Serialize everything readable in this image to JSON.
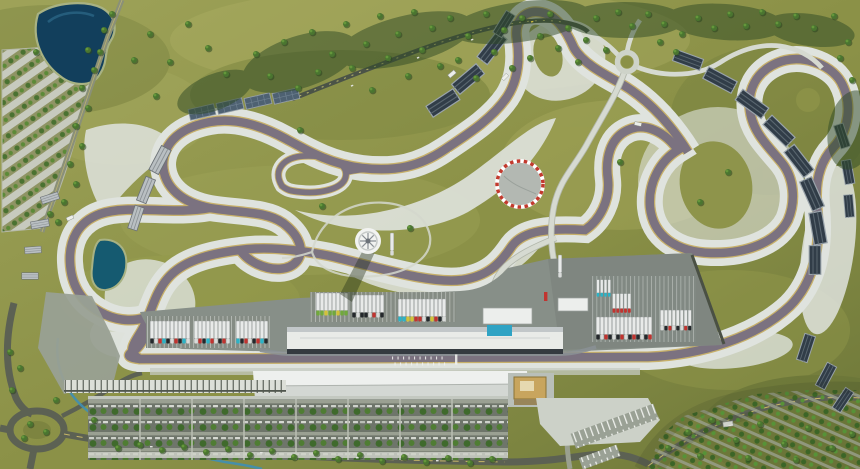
{
  "scene": {
    "kind": "aerial-3d-render",
    "subject": "grand-prix-circuit-complex",
    "view": "top-down"
  },
  "colors": {
    "grass_base": "#8b9147",
    "grass_light": "#a9ad62",
    "grass_dark": "#5f6c34",
    "forest_dark": "#2f4a26",
    "tree_green": "#4a7530",
    "lake_deep": "#123f5c",
    "pond": "#155a70",
    "stream": "#3f8fb4",
    "runoff_pale": "#dfe3de",
    "track_asphalt": "#7b7280",
    "track_curb": "#c7b06a",
    "service_road": "#d6dad1",
    "service_casing": "#b2b7ab",
    "public_road": "#5c6153",
    "road_line": "#d9c66b",
    "paddock_surface": "#878f88",
    "pit_roof": "#e9ebe8",
    "pit_face": "#343a40",
    "grandstand_roof": "#eef0ee",
    "stand_panel": "#313d48",
    "solar_panel": "#4e6172",
    "gold_building": "#c8a55e",
    "pool_blue": "#2fa3c4",
    "helipad_grey": "#b3b8b2",
    "helipad_red": "#c23a2e",
    "truck_white": "#e8eae9"
  },
  "features": {
    "lake": "reservoir lake",
    "west_car_park": "diagonal-row car park",
    "access_road_north": "tree-lined access road",
    "forest_belt": "pine forest belt",
    "race_track": "closed racing circuit with runoff areas",
    "alternate_link": "infield circuit link loop",
    "pit_building": "pit garage building",
    "paddock": "team paddock with truck parking",
    "helipad": "round pad with red-white border",
    "observation_tower": "white circular tower",
    "roundabout_north": "small roundabout",
    "roundabout_southwest": "large landscaped roundabout",
    "main_grandstand": "long white-roofed grandstand",
    "race_control_tower": "gold control building",
    "garage_row": "row of small lock-up garages",
    "fan_parking": "tree-shaded spectator parking grid",
    "orchard_terraces": "terraced olive orchard",
    "grandstand_blocks": "temporary stand blocks around corners",
    "solar_array": "panel array row",
    "pond": "triangular infield pond",
    "stream": "landscaped stream",
    "start_finish": "start-finish grid markings",
    "pool": "blue pool at hospitality building"
  },
  "paddock": {
    "truck_liveries": [
      "white",
      "red",
      "cyan",
      "black",
      "green",
      "yellow"
    ]
  },
  "track": {
    "surface": "asphalt",
    "edge": "painted curbs",
    "layout": "closed circuit with alternate links"
  }
}
